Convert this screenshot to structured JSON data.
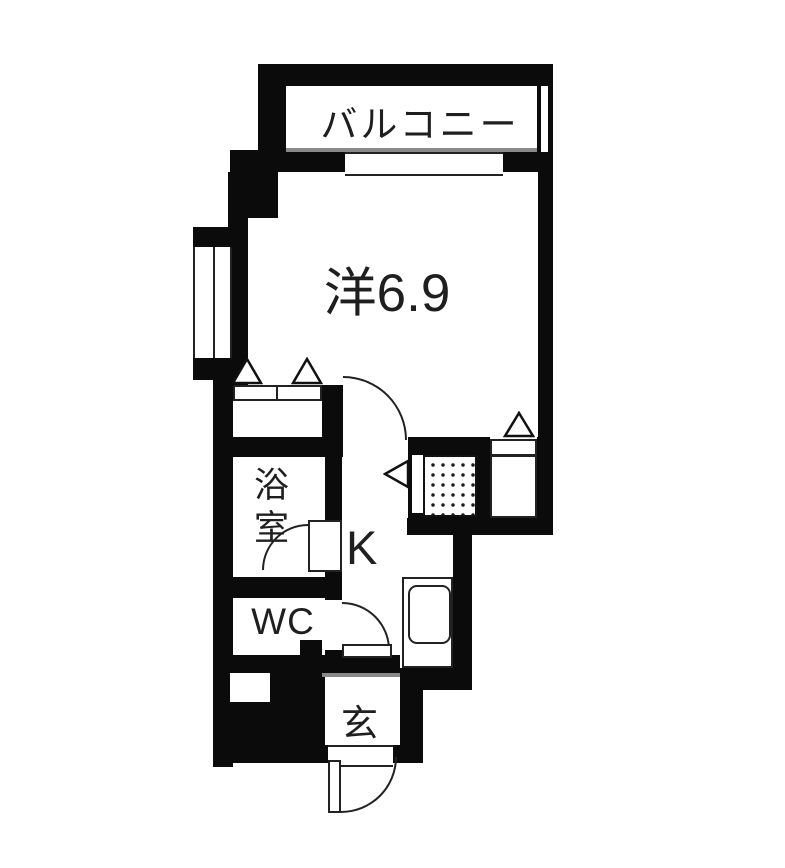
{
  "colors": {
    "wall": "#0b0b0b",
    "background": "#ffffff",
    "line": "#222222",
    "accent_gray": "#8a8a8a"
  },
  "rooms": {
    "balcony": {
      "label": "バルコニー"
    },
    "main": {
      "label": "洋6.9"
    },
    "bathroom": {
      "label": "浴室"
    },
    "kitchen": {
      "label": "K"
    },
    "toilet": {
      "label": "WC"
    },
    "entrance": {
      "label": "玄"
    }
  },
  "symbols": {
    "door_swing_arc": "quarter-circle-arc",
    "folding_door_marker": "hollow-triangle",
    "window": "double-line-window",
    "sliding_door": "white-gap-in-wall",
    "sink": "rounded-rect",
    "pipe_space": "dotted-hatch-square"
  }
}
